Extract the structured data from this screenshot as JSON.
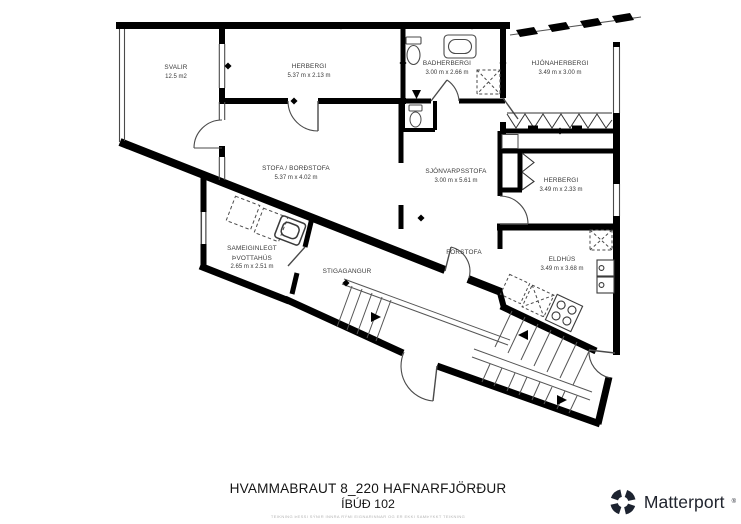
{
  "plan": {
    "rooms": [
      {
        "id": "svalir",
        "name": "SVALIR",
        "dims": "12.5 m2"
      },
      {
        "id": "herbergi-top",
        "name": "HERBERGI",
        "dims": "5.37 m x 2.13 m"
      },
      {
        "id": "badherbergi",
        "name": "BADHERBERGI",
        "dims": "3.00 m x 2.66 m"
      },
      {
        "id": "hjonaherbergi",
        "name": "HJÓNAHERBERGI",
        "dims": "3.49 m x 3.00 m"
      },
      {
        "id": "stofa-bordstofa",
        "name": "STOFA / BORÐSTOFA",
        "dims": "5.37 m x 4.02 m"
      },
      {
        "id": "sjonvarpsstofa",
        "name": "SJÓNVARPSSTOFA",
        "dims": "3.00 m x 5.61 m"
      },
      {
        "id": "herbergi-right",
        "name": "HERBERGI",
        "dims": "3.49 m x 2.33 m"
      },
      {
        "id": "thvottahus",
        "name": "SAMEIGINLEGT",
        "name2": "ÞVOTTAHÚS",
        "dims": "2.65 m x 2.51 m"
      },
      {
        "id": "stigagangur",
        "name": "STIGAGANGUR"
      },
      {
        "id": "forstofa",
        "name": "FORSTOFA"
      },
      {
        "id": "eldhus",
        "name": "ELDHÚS",
        "dims": "3.49 m x 3.68 m"
      }
    ]
  },
  "footer": {
    "address": "HVAMMABRAUT 8_220 HAFNARFJÖRÐUR",
    "unit": "ÍBÚÐ 102",
    "disclaimer": "TEIKNING ÞESSI SÝNIR INNRA RÝMI EIGNARINNAR OG ER EKKI SAMÞYKKT TEIKNING"
  },
  "branding": {
    "name": "Matterport",
    "mark": "®"
  },
  "colors": {
    "wall": "#000000",
    "thin_line": "#4a4a4a",
    "background": "#ffffff",
    "label_text": "#3a3a3a"
  }
}
